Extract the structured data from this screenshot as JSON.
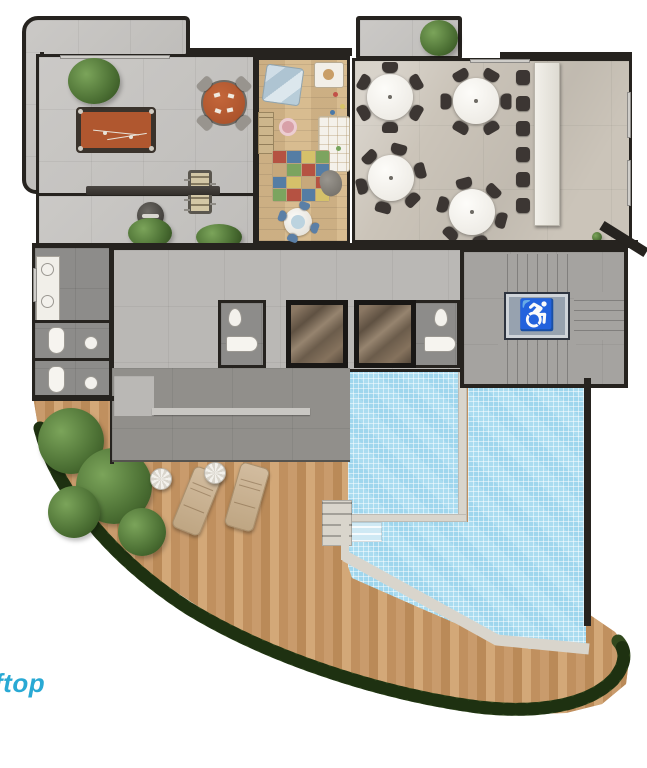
{
  "caption": {
    "text": "ftop"
  },
  "icons": {
    "wheelchair": "♿",
    "plant": "plant",
    "hedge": "hedge"
  },
  "palette": {
    "wall": "#26231f",
    "window": "#cfcdc9",
    "concrete": "#c7c5c2",
    "corridor": "#bab8b5",
    "bath_floor": "#8d8c8a",
    "structure": "#918f8b",
    "stair_floor": "#a5a3a0",
    "dining_floor": "#cbc4b9",
    "wood_deck": "#c1915f",
    "wood_room": "#d8bc90",
    "pool": "#aadcf0",
    "stone": "#d9d5cc",
    "felt": "#b0572f",
    "chair": "#3c3633",
    "hedge": "#2f471d",
    "lift": "#97a2af",
    "lift_glyph": "#2b3550",
    "caption": "#29a9d4"
  },
  "playmat": {
    "colors": [
      "#b5493c",
      "#4a79a8",
      "#d8c468",
      "#76a45c",
      "#c9a97b",
      "#76a45c",
      "#b5493c",
      "#4a79a8",
      "#4a79a8",
      "#d8c468",
      "#c9a97b",
      "#b5493c",
      "#76a45c",
      "#b5493c",
      "#4a79a8",
      "#d8c468"
    ]
  },
  "inventory": {
    "dining_tables": 4,
    "chairs_per_table": 6,
    "bar_stools": 6,
    "card_table_chairs": 4,
    "kids_table_chairs": 4,
    "sun_loungers": 2,
    "side_tables": 2,
    "elevators": 2,
    "billiard_tables": 1,
    "foosball_tables": 1,
    "bbq_grills": 1,
    "pools": 1,
    "toilets": 5,
    "sinks": 7
  }
}
